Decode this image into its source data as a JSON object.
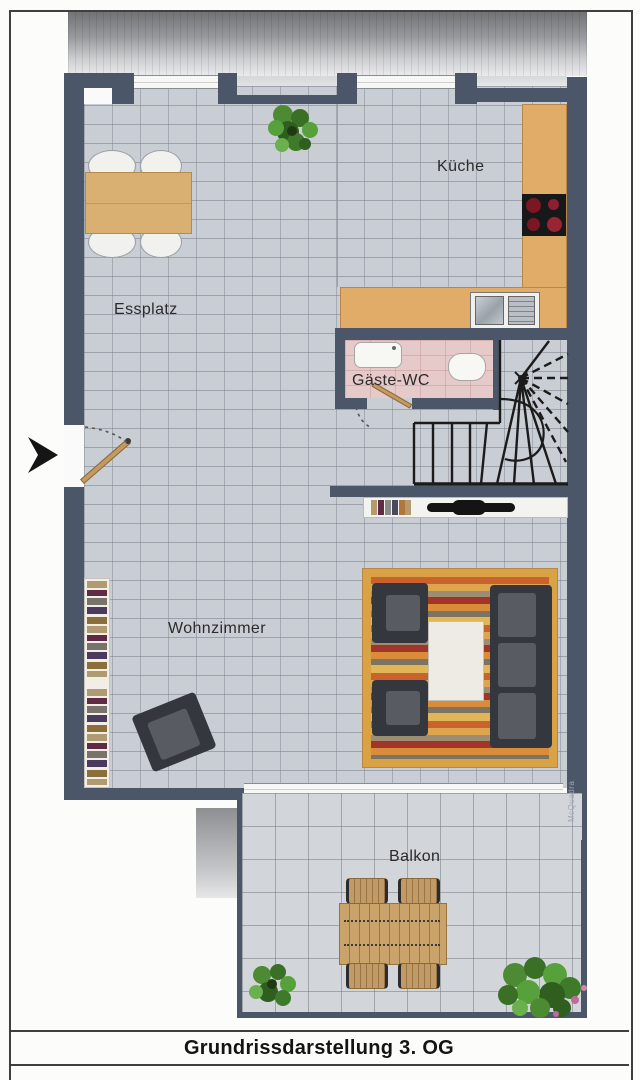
{
  "labels": {
    "kitchen": "Küche",
    "dining": "Essplatz",
    "guest_wc": "Gäste-WC",
    "living": "Wohnzimmer",
    "balcony": "Balkon",
    "title": "Grundrissdarstellung 3. OG",
    "watermark": "McQuadra"
  },
  "colors": {
    "wall": "#4b5768",
    "floor_tile": "#c9cdd4",
    "wc_floor": "#e6caca",
    "counter": "#e0ac68",
    "rug_border": "#d9a245",
    "balcony_floor": "#d2d6db",
    "furniture_dark": "#34383e",
    "wood": "#c49a62",
    "burner_red": "#7a1722"
  }
}
